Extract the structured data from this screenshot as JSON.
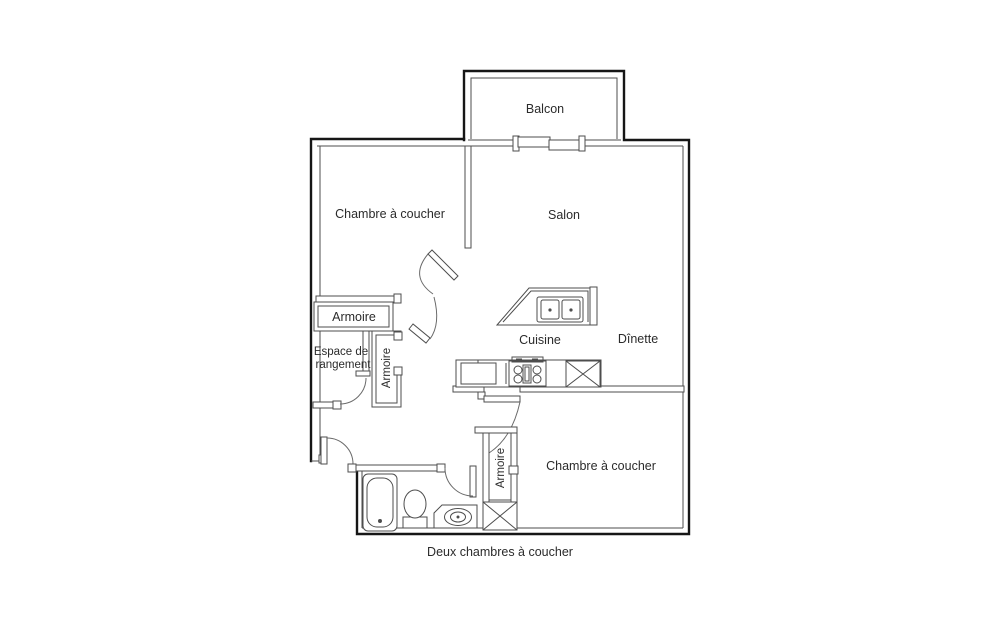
{
  "floorplan": {
    "caption": "Deux chambres à coucher",
    "rooms": {
      "balcony": "Balcon",
      "bedroom1": "Chambre à coucher",
      "living_room": "Salon",
      "kitchen": "Cuisine",
      "dinette": "Dînette",
      "bedroom2": "Chambre à coucher",
      "storage_line1": "Espace de",
      "storage_line2": "rangement",
      "closet_hall_top": "Armoire",
      "closet_hall_side": "Armoire",
      "closet_bedroom2": "Armoire"
    },
    "fixtures": [
      "bathtub",
      "toilet",
      "vanity-sink",
      "kitchen-island-double-sink",
      "stove",
      "refrigerator",
      "dishwasher-x",
      "closet-x-box",
      "sliding-door"
    ],
    "colors": {
      "background": "#ffffff",
      "exterior_wall": "#161616",
      "interior_line": "#4d4d4d",
      "text": "#2b2b2b"
    }
  }
}
